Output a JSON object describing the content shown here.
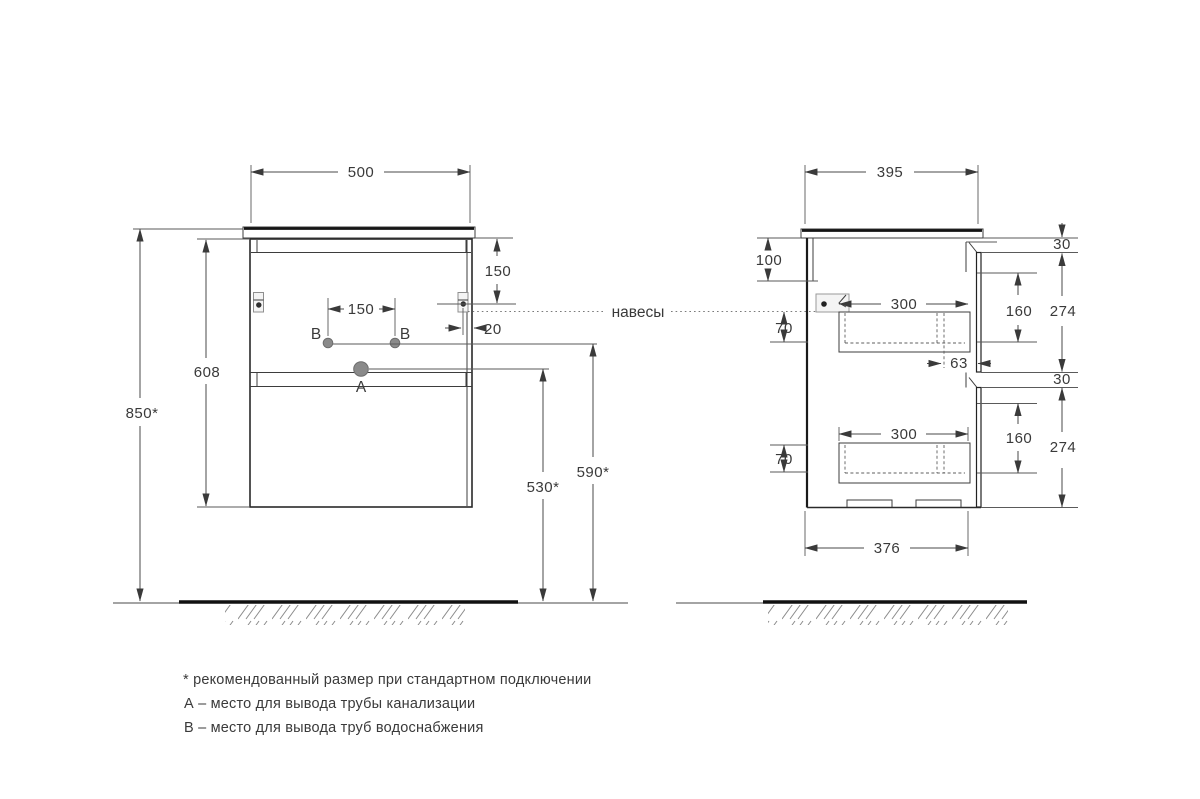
{
  "drawing": {
    "front_view": {
      "width": "500",
      "overall_height": "850*",
      "body_height": "608",
      "bracket_from_top": "150",
      "bracket_side_offset": "20",
      "water_holes_spacing": "150",
      "drain_outlet_height": "530*",
      "water_outlet_height": "590*",
      "drain_label": "A",
      "water_label_left": "B",
      "water_label_right": "B"
    },
    "side_view": {
      "depth": "395",
      "back_rail_height": "100",
      "top_reveal": "30",
      "middle_reveal": "30",
      "front_panel_height_top": "274",
      "front_panel_height_bottom": "274",
      "drawer_inner_height_top": "160",
      "drawer_inner_height_bottom": "160",
      "drawer_depth_top": "300",
      "drawer_depth_bottom": "300",
      "drawer_top_offset_upper": "70",
      "drawer_top_offset_lower": "70",
      "rail_offset": "63",
      "bottom_depth": "376"
    },
    "hangers_label": "навесы",
    "notes": [
      "* рекомендованный размер при стандартном подключении",
      "А – место для вывода трубы канализации",
      "В – место для вывода труб водоснабжения"
    ]
  },
  "colors": {
    "line": "#3a3a3a",
    "line_strong": "#141414",
    "hole_fill": "#8a8a8a",
    "bracket_fill": "#f4f4f4",
    "text": "#3a3a3a",
    "background": "#ffffff"
  }
}
